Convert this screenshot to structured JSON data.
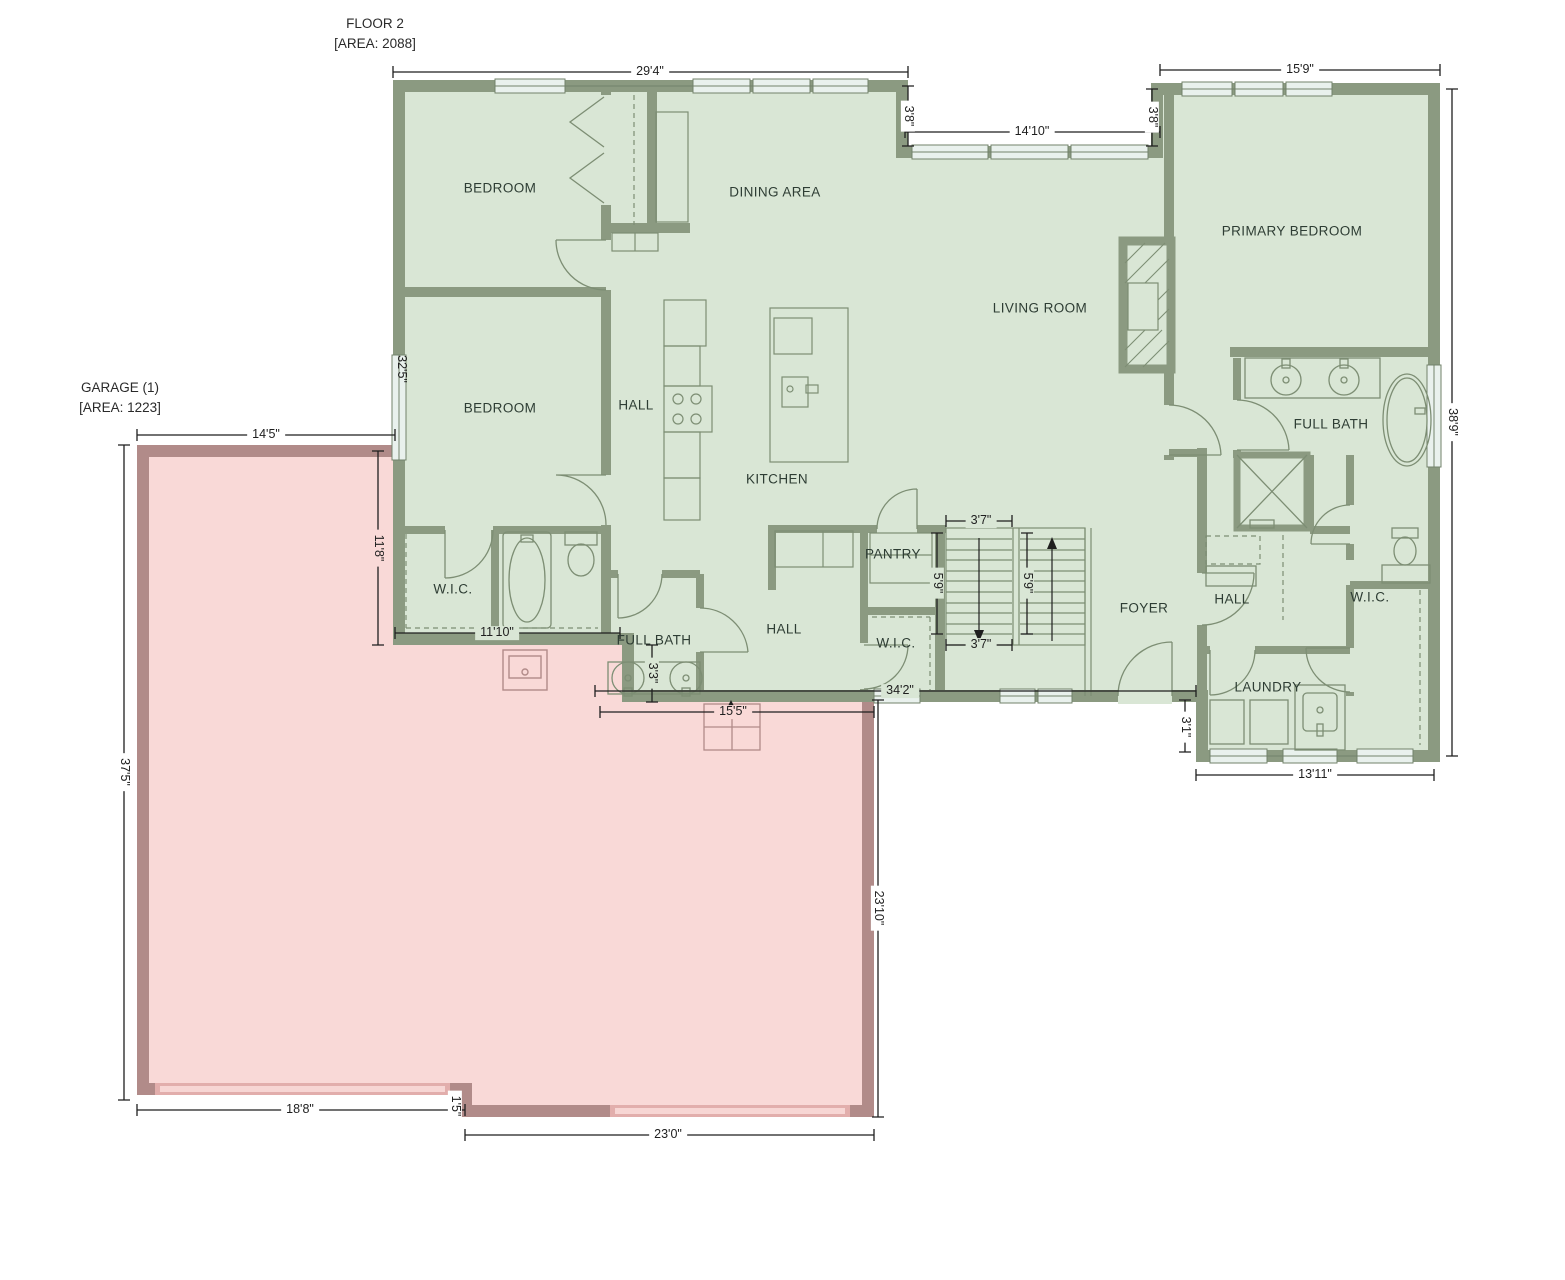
{
  "titles": {
    "floor": {
      "line1": "FLOOR 2",
      "line2": "[AREA: 2088]"
    },
    "garage": {
      "line1": "GARAGE (1)",
      "line2": "[AREA: 1223]"
    }
  },
  "rooms": {
    "bedroom_top": "BEDROOM",
    "bedroom_mid": "BEDROOM",
    "dining_area": "DINING AREA",
    "primary_bedroom": "PRIMARY BEDROOM",
    "living_room": "LIVING ROOM",
    "hall_west": "HALL",
    "kitchen": "KITCHEN",
    "wic_west": "W.I.C.",
    "full_bath_west": "FULL BATH",
    "hall_center": "HALL",
    "pantry": "PANTRY",
    "wic_center": "W.I.C.",
    "foyer": "FOYER",
    "hall_east": "HALL",
    "wic_east": "W.I.C.",
    "full_bath_east": "FULL BATH",
    "laundry": "LAUNDRY"
  },
  "dimensions": {
    "top_width": "29'4\"",
    "primary_width": "15'9\"",
    "inset_left": "3'8\"",
    "inset_right": "3'8\"",
    "dining_windows": "14'10\"",
    "right_height": "38'9\"",
    "left_height": "32'5\"",
    "garage_top": "14'5\"",
    "garage_interior": "11'8\"",
    "bath_width": "11'10\"",
    "bath_step": "3'3\"",
    "entry_width": "15'5\"",
    "main_bottom": "34'2\"",
    "stair_width_top": "3'7\"",
    "stair_width_bottom": "3'7\"",
    "stair_flight_left": "5'9\"",
    "stair_flight_right": "5'9\"",
    "laundry_offset": "3'1\"",
    "laundry_width": "13'11\"",
    "garage_west": "37'5\"",
    "garage_south_left": "18'8\"",
    "garage_notch": "1'5\"",
    "garage_south_right": "23'0\"",
    "garage_east": "23'10\""
  },
  "colors": {
    "floor": "#d9e6d5",
    "wall": "#8b9a81",
    "window": "#e9f1ed",
    "garage_floor": "#f9d9d7",
    "garage_wall": "#b18b89",
    "garage_door": "#e2aeac",
    "garage_door_inner": "#f7d6d4",
    "fixture": "#7d8e74",
    "dimension": "#1f1f1f",
    "room_text": "#2e3d34",
    "title_text": "#2a2a2a"
  }
}
